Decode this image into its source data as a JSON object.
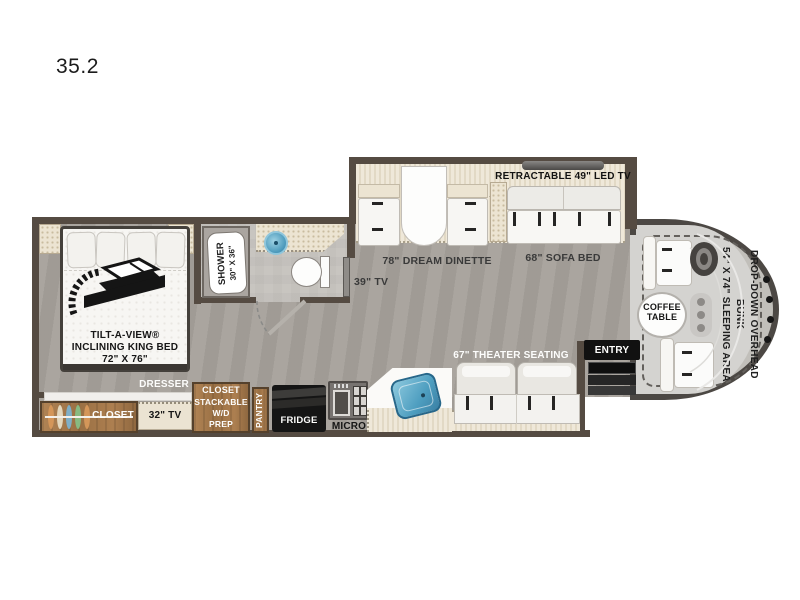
{
  "model": "35.2",
  "bedroom": {
    "bed": {
      "line1": "TILT-A-VIEW®",
      "line2": "INCLINING KING BED",
      "line3": "72\" X 76\""
    },
    "dresser": "DRESSER",
    "closet": "CLOSET",
    "tv": "32\" TV",
    "wardrobe": {
      "line1": "CLOSET",
      "line2": "STACKABLE",
      "line3": "W/D",
      "line4": "PREP"
    },
    "pantry": "PANTRY"
  },
  "bathroom": {
    "shower_line1": "SHOWER",
    "shower_line2": "30\" X 36\""
  },
  "galley": {
    "fridge": "FRIDGE",
    "micro": "MICRO"
  },
  "living": {
    "tv39": "39\" TV",
    "dinette": "78\" DREAM DINETTE",
    "sofa": "68\" SOFA BED",
    "retractable_tv": "RETRACTABLE 49\" LED TV",
    "theater": "67\" THEATER SEATING"
  },
  "entry": "ENTRY",
  "cab": {
    "coffee_line1": "COFFEE",
    "coffee_line2": "TABLE",
    "bunk_line1": "DROP-DOWN OVERHEAD BUNK",
    "bunk_line2": "54\" X 74\" SLEEPING AREA"
  },
  "colors": {
    "wall": "#554b42",
    "floor": "#a6a19b",
    "slide_floor": "#ece4d3",
    "wood": "#a87d50",
    "sink_blue": "#5aa8c6",
    "accent_black": "#141414"
  }
}
